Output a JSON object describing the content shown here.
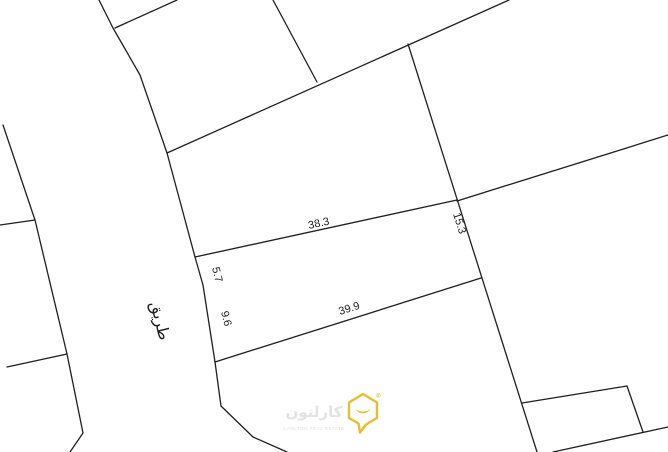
{
  "canvas": {
    "background": "#ffffff",
    "line_color": "#1f1f1f"
  },
  "dimensions": {
    "plot_top_boundary": "38.3",
    "east_side": "15.3",
    "road_frontage_upper": "5.7",
    "road_frontage_lower": "9.6",
    "plot_bottom_boundary": "39.9"
  },
  "road": {
    "label_ar": "طريق"
  },
  "watermark": {
    "brand_ar": "كارلتون",
    "brand_en": "CARLTON REAL ESTATE",
    "registered_mark": "®",
    "icon": "carlton-smile-house-icon",
    "icon_color": "#e9bc31",
    "text_color": "#e3e3e3"
  }
}
